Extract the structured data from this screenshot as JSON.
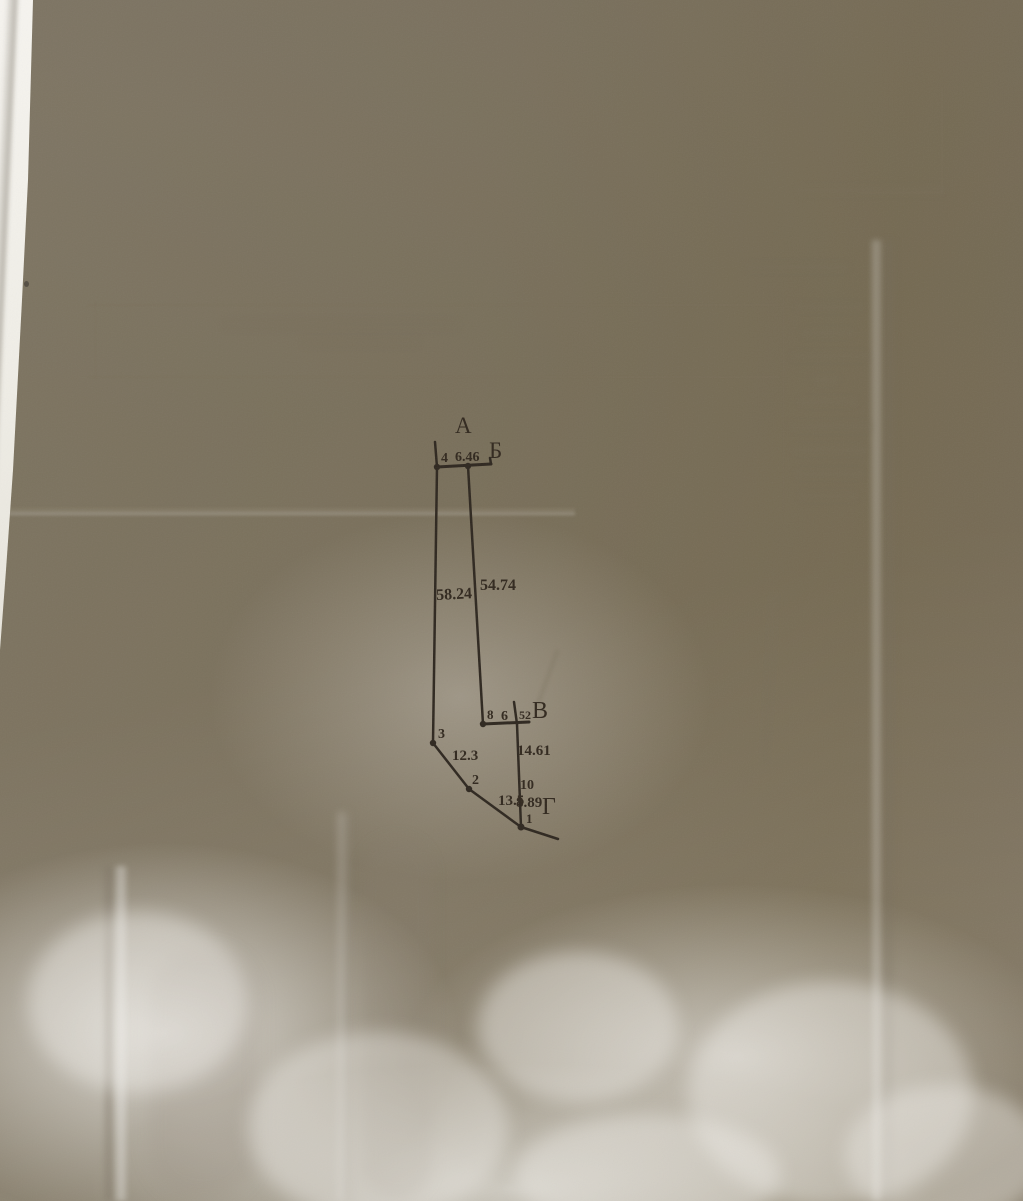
{
  "photo": {
    "description": "Photograph of a creased sheet of paper bearing a hand-drafted cadastral boundary sketch; faint mirrored table text shows through from the reverse side",
    "ink_color": "#32291f",
    "paper_tone_top_left": "#b4aea2",
    "paper_tone_right": "#a89f8a",
    "paper_tone_bottom": "#ccc8bd",
    "underlying_sheet_color": "#f5f3ee"
  },
  "diagram": {
    "corner_a": "А",
    "corner_b": "Б",
    "corner_v": "В",
    "corner_g": "Г",
    "point_4": "4",
    "point_3": "3",
    "point_2": "2",
    "point_1": "1",
    "point_8": "8",
    "point_10": "10",
    "len_4_b": "6.46",
    "len_4_3": "58.24",
    "len_b_v": "54.74",
    "len_8_part1": "6",
    "len_8_part2": "52",
    "len_v_10": "14.61",
    "len_3_2": "12.3",
    "len_2_1": "13.5",
    "len_10_1": "8.89"
  }
}
